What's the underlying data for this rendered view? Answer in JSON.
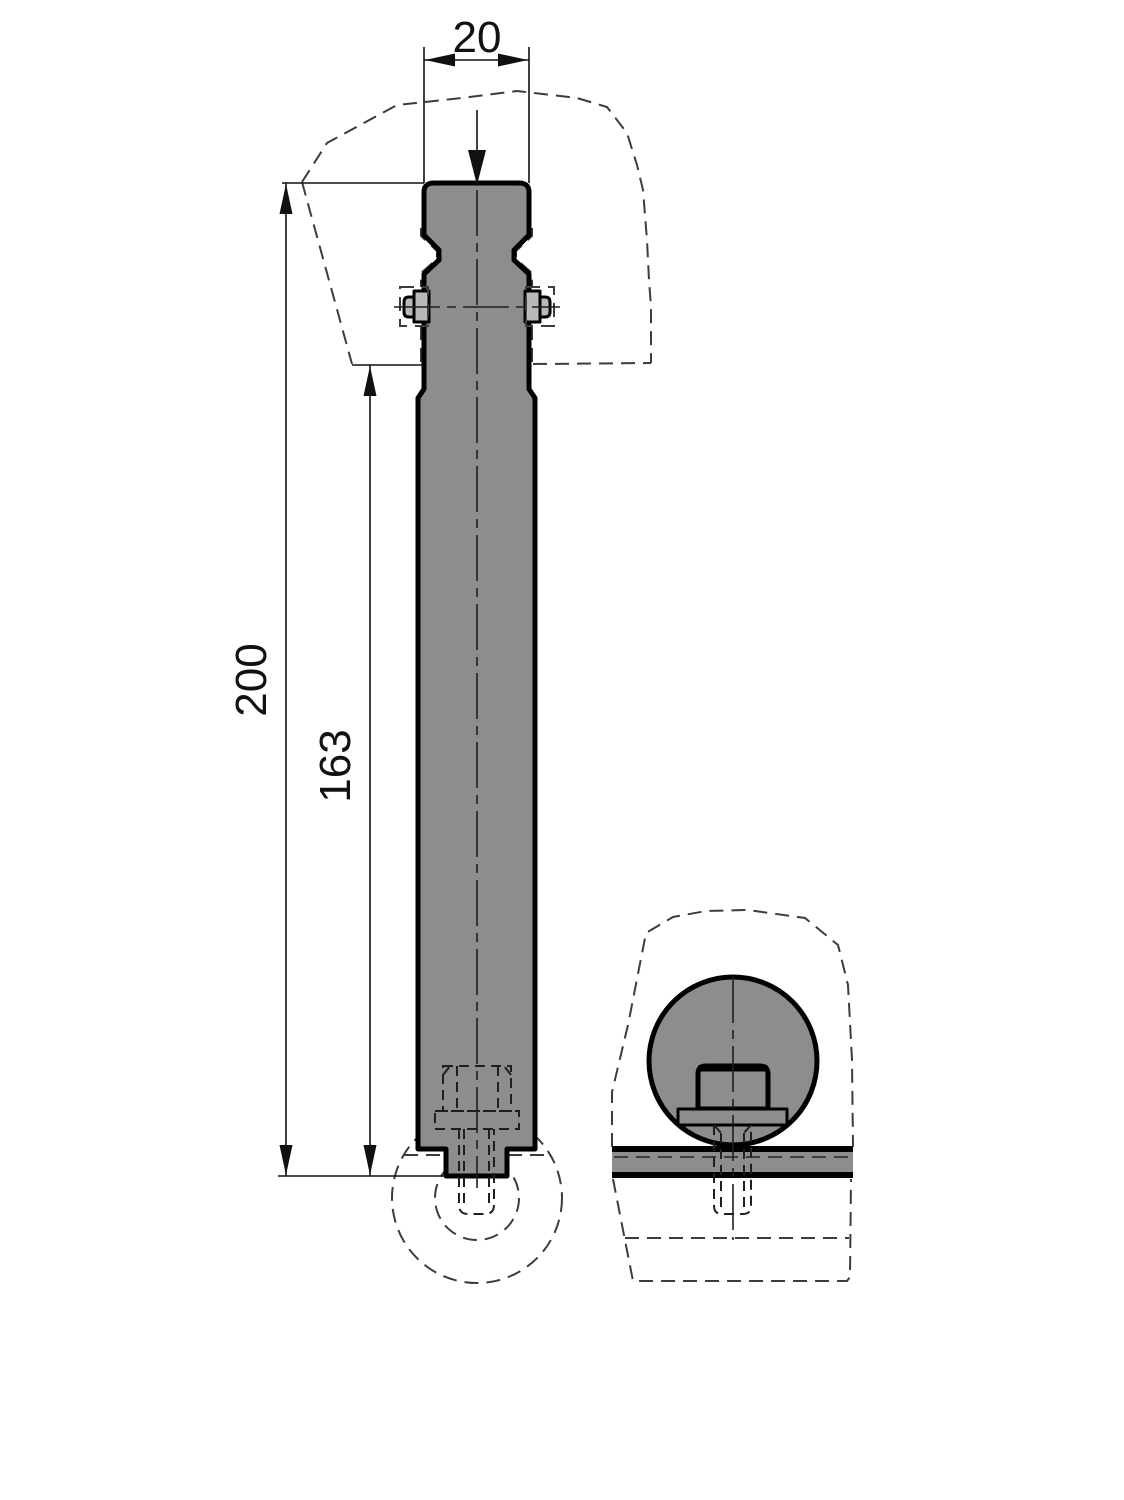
{
  "drawing": {
    "dimensions": {
      "width_label": "20",
      "overall_length_label": "200",
      "exposed_length_label": "163"
    },
    "colors": {
      "background": "#ffffff",
      "line": "#000000",
      "part_fill": "#8d8d8d",
      "pin_fill": "#b9b9b9"
    }
  }
}
